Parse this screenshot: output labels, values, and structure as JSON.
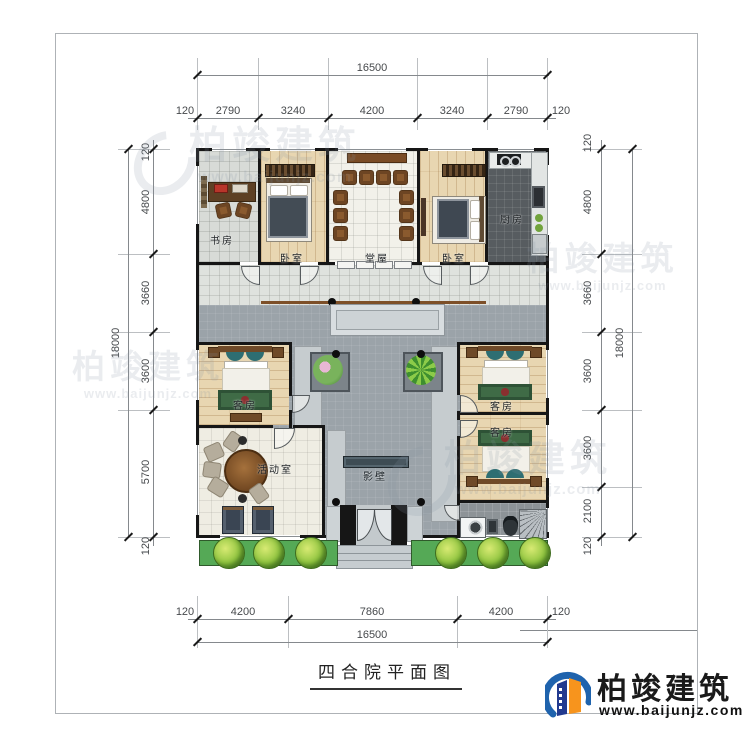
{
  "title": {
    "text": "四合院平面图"
  },
  "logo": {
    "name": "柏竣建筑",
    "url": "www.baijunjz.com"
  },
  "watermark": {
    "name": "柏竣建筑",
    "url": "www.baijunjz.com"
  },
  "rooms": {
    "study": {
      "label": "书房"
    },
    "bedroom_left": {
      "label": "卧室"
    },
    "hall": {
      "label": "堂屋"
    },
    "bedroom_right": {
      "label": "卧室"
    },
    "kitchen": {
      "label": "厨房"
    },
    "guest_left": {
      "label": "客房"
    },
    "activity": {
      "label": "活动室"
    },
    "guest_right_1": {
      "label": "客房"
    },
    "guest_right_2": {
      "label": "客房"
    },
    "screen_wall": {
      "label": "影壁"
    }
  },
  "dimensions": {
    "top": {
      "total": "16500",
      "segments": [
        "120",
        "2790",
        "3240",
        "4200",
        "3240",
        "2790",
        "120"
      ]
    },
    "bottom": {
      "total": "16500",
      "segments": [
        "120",
        "4200",
        "7860",
        "4200",
        "120"
      ]
    },
    "left": {
      "total": "18000",
      "segments": [
        "120",
        "4800",
        "3660",
        "3600",
        "5700",
        "120"
      ]
    },
    "right": {
      "total": "18000",
      "segments": [
        "120",
        "4800",
        "3660",
        "3600",
        "3600",
        "2100",
        "120"
      ]
    }
  },
  "colors": {
    "wall": "#161616",
    "courtyard": "#9ba3a9",
    "wood": "#e8d6b1",
    "grass": "#55a956",
    "screen_wall": "#3e4c54",
    "logo_blue": "#1f63ad",
    "logo_orange": "#f7941d",
    "logo_navy": "#223a8f"
  }
}
